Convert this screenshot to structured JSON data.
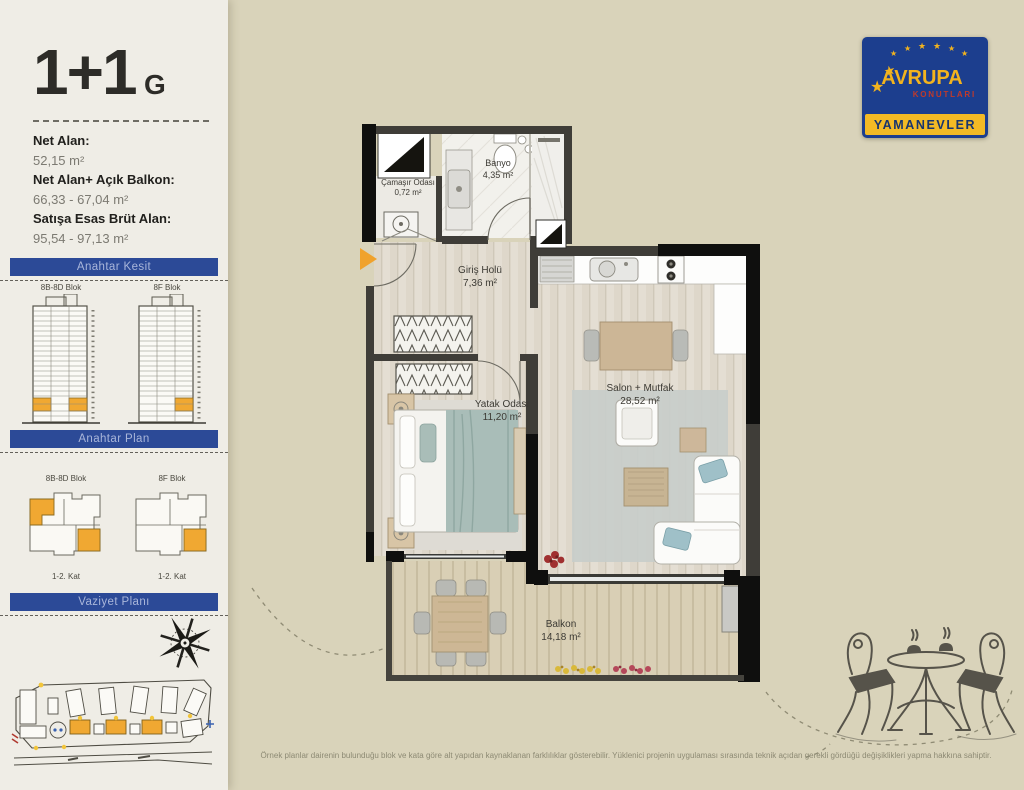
{
  "page": {
    "title": "1+1",
    "title_suffix": "G",
    "disclaimer": "Örnek planlar dairenin bulunduğu blok ve kata göre alt yapıdan kaynaklanan farklılıklar gösterebilir. Yüklenici projenin uygulaması sırasında teknik açıdan gerekli gördüğü değişiklikleri yapma hakkına sahiptir."
  },
  "info": {
    "items": [
      {
        "label": "Net Alan:",
        "value": "52,15 m²"
      },
      {
        "label": "Net Alan+ Açık Balkon:",
        "value": "66,33 - 67,04 m²"
      },
      {
        "label": "Satışa Esas Brüt Alan:",
        "value": "95,54 - 97,13 m²"
      }
    ]
  },
  "sections": {
    "kesit": {
      "title": "Anahtar Kesit",
      "towers": [
        {
          "label": "8B-8D Blok"
        },
        {
          "label": "8F Blok"
        }
      ]
    },
    "plan": {
      "title": "Anahtar Plan",
      "plans": [
        {
          "label": "8B-8D Blok",
          "caption": "1-2. Kat"
        },
        {
          "label": "8F Blok",
          "caption": "1-2. Kat"
        }
      ]
    },
    "vaziyet": {
      "title": "Vaziyet Planı"
    }
  },
  "logo": {
    "brand": "AVRUPA",
    "sub": "KONUTLARI",
    "project": "YAMANEVLER"
  },
  "floorplan": {
    "rooms": [
      {
        "name": "Çamaşır Odası",
        "area": "0,72 m²"
      },
      {
        "name": "Banyo",
        "area": "4,35 m²"
      },
      {
        "name": "Giriş Holü",
        "area": "7,36 m²"
      },
      {
        "name": "Yatak Odası",
        "area": "11,20 m²"
      },
      {
        "name": "Salon + Mutfak",
        "area": "28,52 m²"
      },
      {
        "name": "Balkon",
        "area": "14,18 m²"
      }
    ]
  },
  "colors": {
    "background": "#d9d3ba",
    "sidebar": "#efede6",
    "section_bar": "#2c4a97",
    "highlight_orange": "#f0a832",
    "logo_blue": "#1c3e8e",
    "logo_yellow": "#f3ba25",
    "wall_dark": "#3f3d38",
    "wall_black": "#0f0f0e"
  }
}
